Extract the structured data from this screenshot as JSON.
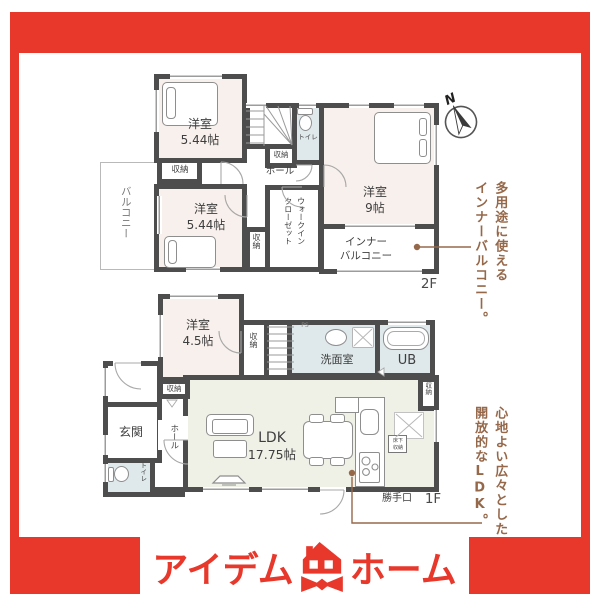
{
  "colors": {
    "accent_red": "#e7382b",
    "annotation_brown": "#96684a",
    "wall": "#4d4d4d",
    "room_pink": "#f8f0ec",
    "room_green": "#eff1e7",
    "room_blue": "#dfe8ea"
  },
  "compass": {
    "label": "N"
  },
  "floor2": {
    "floor_label": "2F",
    "bedroom_nw": {
      "name": "洋室",
      "size": "5.44帖"
    },
    "bedroom_sw": {
      "name": "洋室",
      "size": "5.44帖"
    },
    "bedroom_e": {
      "name": "洋室",
      "size": "9帖"
    },
    "balcony": "バルコニー",
    "inner_balcony": {
      "line1": "インナー",
      "line2": "バルコニー"
    },
    "wic": "ウォークイン\nクローゼット",
    "toilet": "トイレ",
    "hall": "ホール",
    "closet_nw": "収納",
    "closet_stairs": "収納",
    "closet_sw": "収納"
  },
  "floor1": {
    "floor_label": "1F",
    "bedroom": {
      "name": "洋室",
      "size": "4.5帖"
    },
    "ldk": {
      "name": "LDK",
      "size": "17.75帖"
    },
    "washroom": "洗面室",
    "bath": "UB",
    "entrance": "玄関",
    "hall": "ホール",
    "toilet": "トイレ",
    "closet_bedroom": "収納",
    "closet_hall": "収納",
    "closet_kitchen": "収納",
    "floor_storage": "床下\n収納",
    "back_door": "勝手口",
    "pipe_space": "PS"
  },
  "annotations": {
    "inner_balcony": {
      "line1": "多用途に使える",
      "line2": "インナーバルコニー。"
    },
    "ldk": {
      "line1": "心地よい広々とした",
      "line2": "開放的なLDK。"
    }
  },
  "logo": {
    "name_left": "アイデム",
    "name_right": "ホーム"
  }
}
